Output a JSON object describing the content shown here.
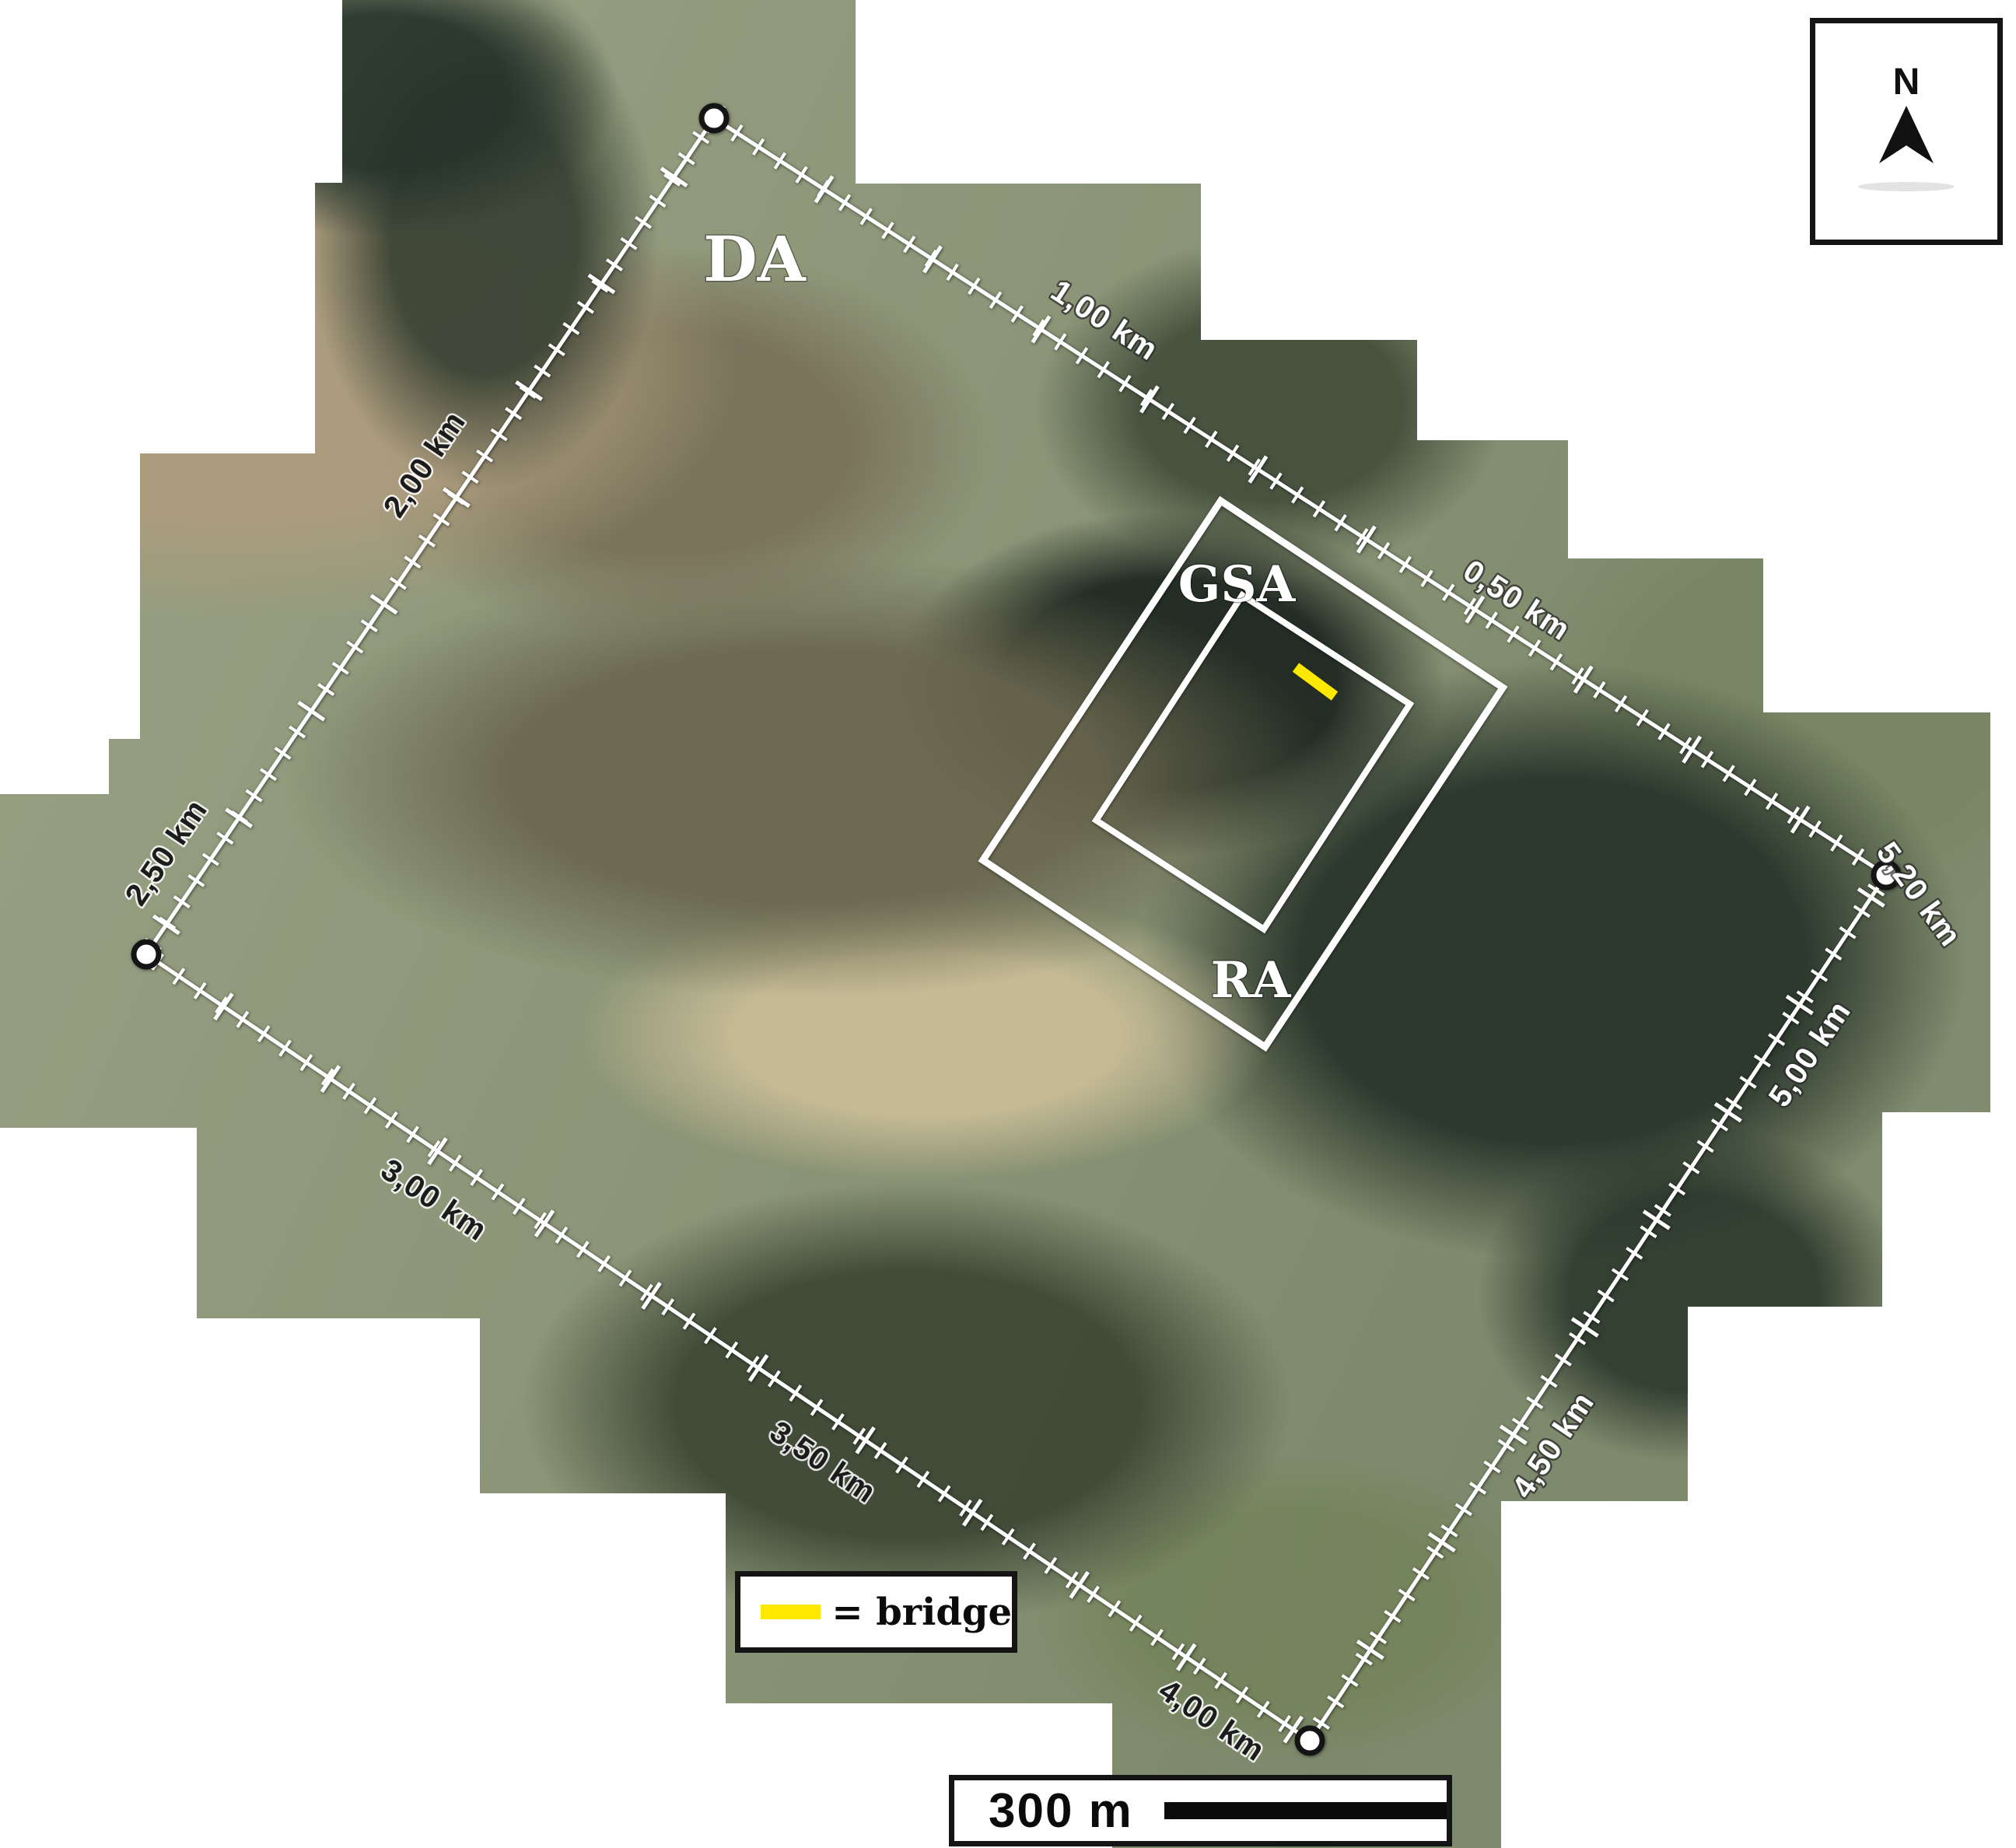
{
  "figure": {
    "type": "aerial-mosaic-study-area-map"
  },
  "map": {
    "region_labels": [
      {
        "label": "DA"
      },
      {
        "label": "GSA"
      },
      {
        "label": "RA"
      }
    ],
    "distance_markers": [
      "1,00 km",
      "0,50 km",
      "2,00 km",
      "2,50 km",
      "3,00 km",
      "3,50 km",
      "4,00 km",
      "4,50 km",
      "5,00 km",
      "5,20 km"
    ]
  },
  "legend": {
    "bridge_label": "= bridge",
    "bridge_color": "#FFE800"
  },
  "scale_bar": {
    "label": "300 m"
  },
  "compass": {
    "label": "N"
  },
  "colors": {
    "annotation": "#ffffff",
    "outline": "#141414",
    "bridge": "#FFE800",
    "background": "#ffffff"
  }
}
